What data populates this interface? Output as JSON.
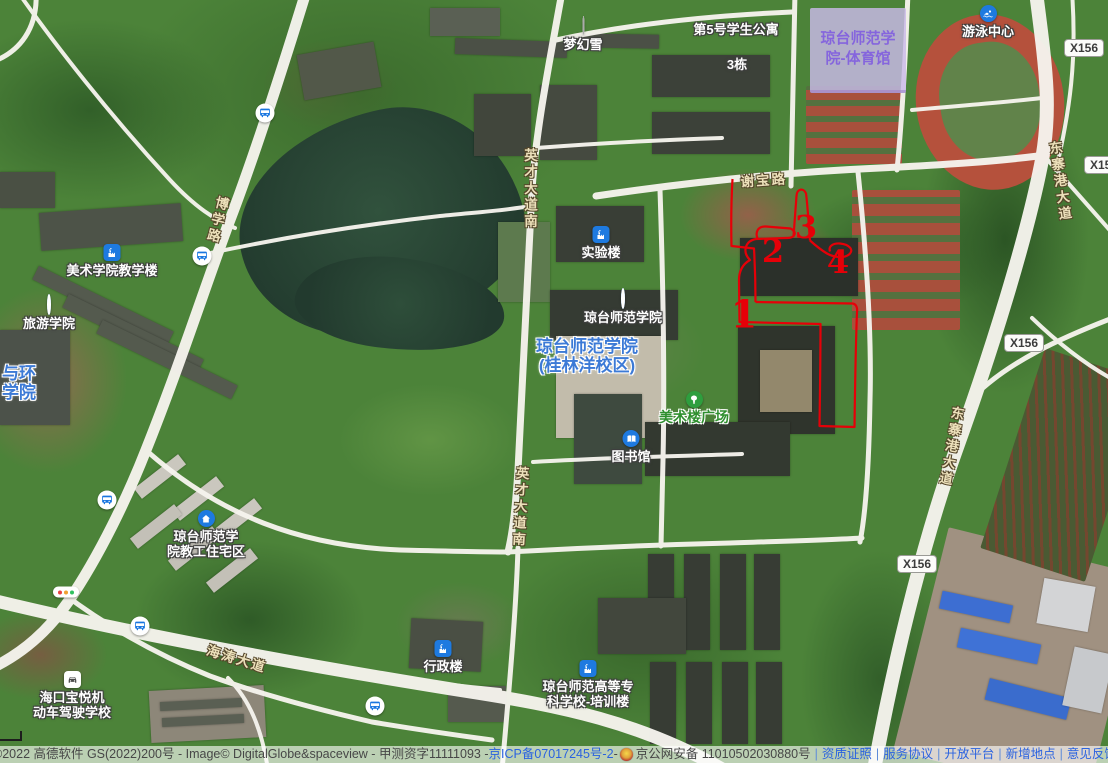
{
  "map": {
    "pois": [
      {
        "id": "menghuanxue",
        "lines": [
          "梦幻雪"
        ],
        "x": 583,
        "y": 17,
        "icon": "dot-white"
      },
      {
        "id": "student-apartment-5",
        "lines": [
          "第5号学生公寓"
        ],
        "x": 736,
        "y": 22
      },
      {
        "id": "building-3dong",
        "lines": [
          "3栋"
        ],
        "x": 737,
        "y": 57
      },
      {
        "id": "shiyanlou",
        "lines": [
          "实验楼"
        ],
        "x": 601,
        "y": 226,
        "icon": "building"
      },
      {
        "id": "qiongtai-normal-college-poi",
        "lines": [
          "琼台师范学院"
        ],
        "x": 623,
        "y": 290,
        "icon": "dot-blue"
      },
      {
        "id": "library",
        "lines": [
          "图书馆"
        ],
        "x": 631,
        "y": 430,
        "icon": "book"
      },
      {
        "id": "art-college-teaching-building",
        "lines": [
          "美术学院教学楼"
        ],
        "x": 112,
        "y": 244,
        "icon": "building"
      },
      {
        "id": "tourism-college",
        "lines": [
          "旅游学院"
        ],
        "x": 49,
        "y": 296,
        "icon": "dot-blue"
      },
      {
        "id": "staff-housing",
        "lines": [
          "琼台师范学",
          "院教工住宅区"
        ],
        "x": 206,
        "y": 510,
        "icon": "home"
      },
      {
        "id": "driving-school",
        "lines": [
          "海口宝悦机",
          "动车驾驶学校"
        ],
        "x": 72,
        "y": 671,
        "icon": "car"
      },
      {
        "id": "admin-building",
        "lines": [
          "行政楼"
        ],
        "x": 443,
        "y": 640,
        "icon": "building"
      },
      {
        "id": "training-building",
        "lines": [
          "琼台师范高等专",
          "科学校-培训楼"
        ],
        "x": 588,
        "y": 660,
        "icon": "building"
      },
      {
        "id": "swimming-center",
        "lines": [
          "游泳中心"
        ],
        "x": 988,
        "y": 5,
        "icon": "swim"
      },
      {
        "id": "campus-name",
        "lines": [
          "琼台师范学院",
          "(桂林洋校区)"
        ],
        "x": 587,
        "y": 337,
        "style": "blue-big"
      },
      {
        "id": "art-plaza",
        "lines": [
          "美术楼广场"
        ],
        "x": 694,
        "y": 391,
        "icon": "tree",
        "style": "green"
      },
      {
        "id": "partial-college",
        "lines": [
          "与环",
          "学院"
        ],
        "x": 2,
        "y": 364,
        "style": "blue-big",
        "align": "left"
      }
    ],
    "road_labels": [
      {
        "text": "谢宝路",
        "x": 763,
        "y": 169,
        "vertical": false,
        "rot": -4
      },
      {
        "text": "博学路",
        "x": 222,
        "y": 196,
        "vertical": true,
        "rot": 14
      },
      {
        "text": "英才大道南",
        "x": 529,
        "y": 148,
        "vertical": true,
        "rot": 0
      },
      {
        "text": "英才大道南",
        "x": 521,
        "y": 466,
        "vertical": true,
        "rot": 3
      },
      {
        "text": "东寨港大道",
        "x": 1053,
        "y": 141,
        "vertical": true,
        "rot": -8
      },
      {
        "text": "东寨港大道",
        "x": 957,
        "y": 406,
        "vertical": true,
        "rot": 10
      },
      {
        "text": "海涛大道",
        "x": 240,
        "y": 648,
        "vertical": false,
        "rot": 17
      }
    ],
    "shields": [
      {
        "text": "X156",
        "x": 1084,
        "y": 48
      },
      {
        "text": "X156",
        "x": 1104,
        "y": 165
      },
      {
        "text": "X156",
        "x": 1024,
        "y": 343
      },
      {
        "text": "X156",
        "x": 917,
        "y": 564
      }
    ],
    "bus_stops": [
      [
        265,
        113
      ],
      [
        202,
        256
      ],
      [
        107,
        500
      ],
      [
        140,
        626
      ],
      [
        375,
        706
      ]
    ],
    "traffic_lights": [
      [
        66,
        592
      ]
    ],
    "gym_area": {
      "lines": [
        "琼台师范学",
        "院-体育馆"
      ],
      "x": 810,
      "y": 8,
      "w": 96,
      "h": 82
    },
    "annotation": {
      "color": "#e60008",
      "numbers": [
        {
          "n": "1",
          "x": 744,
          "y": 314,
          "size": 38
        },
        {
          "n": "2",
          "x": 773,
          "y": 251,
          "size": 32
        },
        {
          "n": "3",
          "x": 806,
          "y": 227,
          "size": 32
        },
        {
          "n": "4",
          "x": 838,
          "y": 262,
          "size": 32
        }
      ],
      "paths": [
        "M732.5,179 C731,205 731,225 731.5,246 L754,248.5 C755,266 755.5,284 755.5,302",
        "M755.5,302 L852.5,303.5 C856.5,304 857.5,308 857,312 C855.5,350 855,390 854.5,427 L819.5,426 C820,392 820.5,358 820.5,324 L739.5,322 L739,280 C739,270 743,264 750,260 C742,252 745,241 756,239 L786,238 C795,238.5 798,232 790.5,228.5 L766,226.5 C758,226 755,232 757.5,238.5",
        "M793.5,236.5 C794.5,222 795.5,208 796.5,196 C797,188.5 803.5,187.5 806,193.5 C807.5,204 808.5,222 810,240.5",
        "M810,240.5 C815,245 821,250 827,253.5 C834,257.5 844,258.5 849,254.5 C854.5,250 849.5,244.5 840,243.5 C833.5,243 828,246 830,251.5"
      ]
    },
    "footer": {
      "copyright": "©2022 高德软件 GS(2022)200号 - Image© DigitalGlobe&spaceview - 甲测资字11111093 - ",
      "icp": "京ICP备07017245号-2",
      "dash": " - ",
      "beian": "京公网安备 11010502030880号",
      "links": [
        "资质证照",
        "服务协议",
        "开放平台",
        "新增地点",
        "意见反馈",
        "商户"
      ]
    },
    "colors": {
      "poi_text": "#ffffff",
      "road_text": "#ece0ba",
      "blue_label": "#3c7ad6",
      "green_label": "#2f8f2f",
      "purple_label": "#8565dd",
      "link": "#2a62e0",
      "annotation": "#e60008"
    }
  }
}
